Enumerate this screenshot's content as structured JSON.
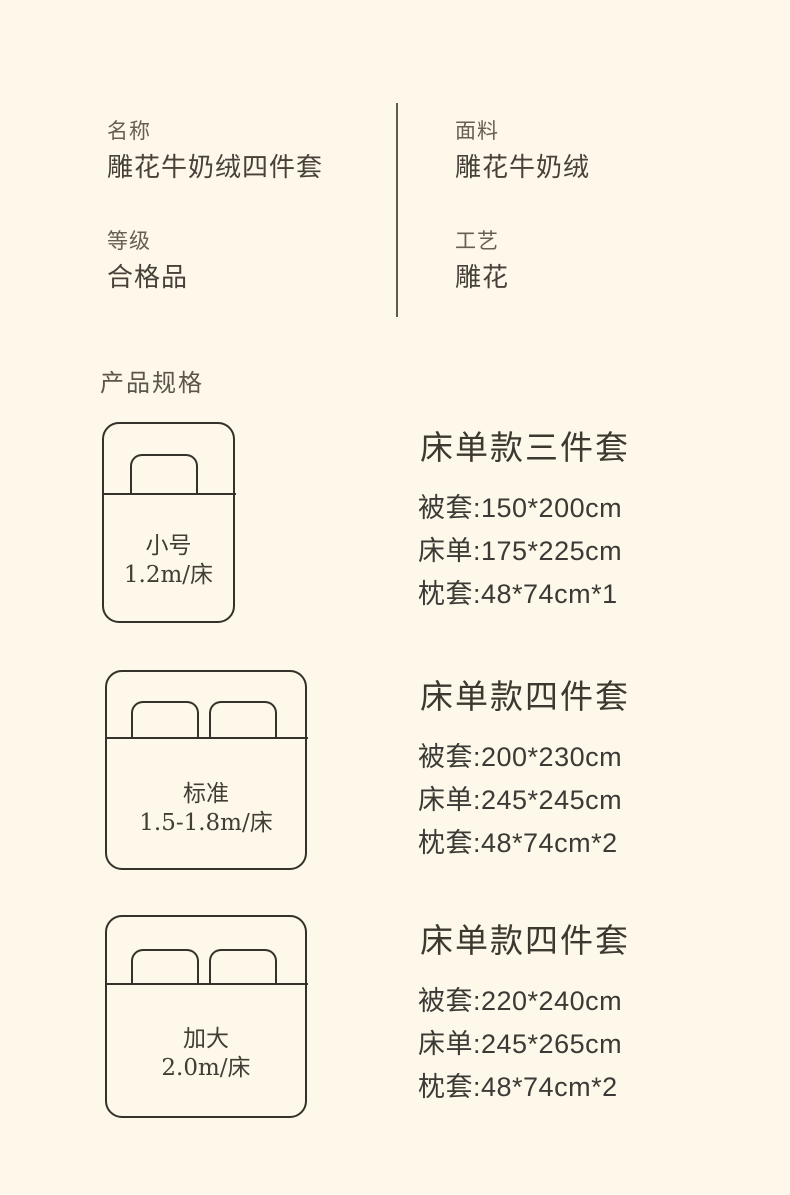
{
  "colors": {
    "background": "#FDF8E9",
    "ink": "#35312b",
    "label_text": "#675f53",
    "value_text": "#47413a",
    "divider": "#5f5a50"
  },
  "attributes": {
    "left": [
      {
        "label": "名称",
        "value": "雕花牛奶绒四件套"
      },
      {
        "label": "等级",
        "value": "合格品"
      }
    ],
    "right": [
      {
        "label": "面料",
        "value": "雕花牛奶绒"
      },
      {
        "label": "工艺",
        "value": "雕花"
      }
    ]
  },
  "section_title": "产品规格",
  "sizes": [
    {
      "bed": {
        "name": "小号",
        "spec": "1.2m/床",
        "pillows": 1
      },
      "set": {
        "title": "床单款三件套",
        "items": [
          "被套:150*200cm",
          "床单:175*225cm",
          "枕套:48*74cm*1"
        ]
      }
    },
    {
      "bed": {
        "name": "标准",
        "spec": "1.5-1.8m/床",
        "pillows": 2
      },
      "set": {
        "title": "床单款四件套",
        "items": [
          "被套:200*230cm",
          "床单:245*245cm",
          "枕套:48*74cm*2"
        ]
      }
    },
    {
      "bed": {
        "name": "加大",
        "spec": "2.0m/床",
        "pillows": 2
      },
      "set": {
        "title": "床单款四件套",
        "items": [
          "被套:220*240cm",
          "床单:245*265cm",
          "枕套:48*74cm*2"
        ]
      }
    }
  ]
}
